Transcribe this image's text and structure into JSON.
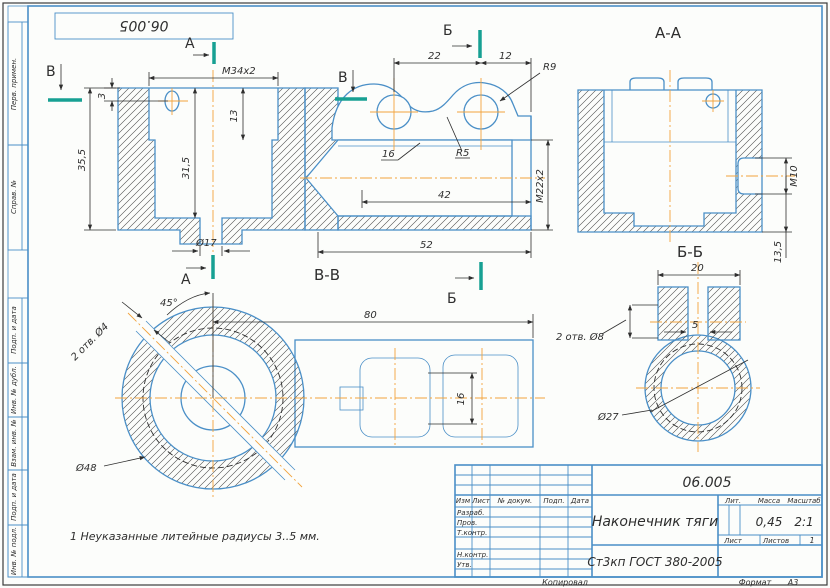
{
  "sheet": {
    "stamp_top": "06.005",
    "note": "1 Неуказанные литейные радиусы 3..5 мм.",
    "copied_label": "Копировал",
    "format_label": "Формат",
    "format_value": "А3"
  },
  "margin_labels": {
    "top": [
      "Перв. примен.",
      "Справ. №"
    ],
    "bottom": [
      "Подп. и дата",
      "Инв. № дубл.",
      "Взам. инв. №",
      "Подп. и дата",
      "Инв. № подл."
    ]
  },
  "sections": {
    "a": "А",
    "b": "Б",
    "v": "В",
    "aa": "А-А",
    "bb": "Б-Б",
    "vv": "В-В"
  },
  "dims": {
    "main": {
      "thread": "М34х2",
      "d3": "3",
      "d13": "13",
      "d315": "31,5",
      "d355": "35,5",
      "d17": "Ø17"
    },
    "mid": {
      "d22": "22",
      "d12": "12",
      "r9": "R9",
      "d16": "16",
      "r5": "R5",
      "d42": "42",
      "thread": "М22х2",
      "d52": "52"
    },
    "aa": {
      "thread": "М10",
      "d135": "13,5"
    },
    "bb": {
      "d20": "20",
      "d5": "5",
      "holes": "2 отв. Ø8",
      "d27": "Ø27"
    },
    "vv": {
      "angle": "45°",
      "holes": "2 отв. Ø4",
      "d48": "Ø48",
      "d80": "80",
      "d16": "16"
    }
  },
  "title_block": {
    "doc_number": "06.005",
    "part_name": "Наконечник тяги",
    "material": "Ст3кп ГОСТ 380-2005",
    "header": [
      "Изм",
      "Лист",
      "№ докум.",
      "Подп.",
      "Дата"
    ],
    "roles": [
      "Разраб.",
      "Пров.",
      "Т.контр.",
      "Н.контр.",
      "Утв."
    ],
    "lit_label": "Лит.",
    "mass_label": "Масса",
    "scale_label": "Масштаб",
    "mass_value": "0,45",
    "scale_value": "2:1",
    "sheet_label": "Лист",
    "sheets_label": "Листов",
    "sheets_value": "1"
  },
  "colors": {
    "outline_blue": "#4a8fc7",
    "centerline_orange": "#f2a33c",
    "section_teal": "#17a093",
    "ink": "#2e2e2e",
    "paper": "#fcfdfb"
  }
}
